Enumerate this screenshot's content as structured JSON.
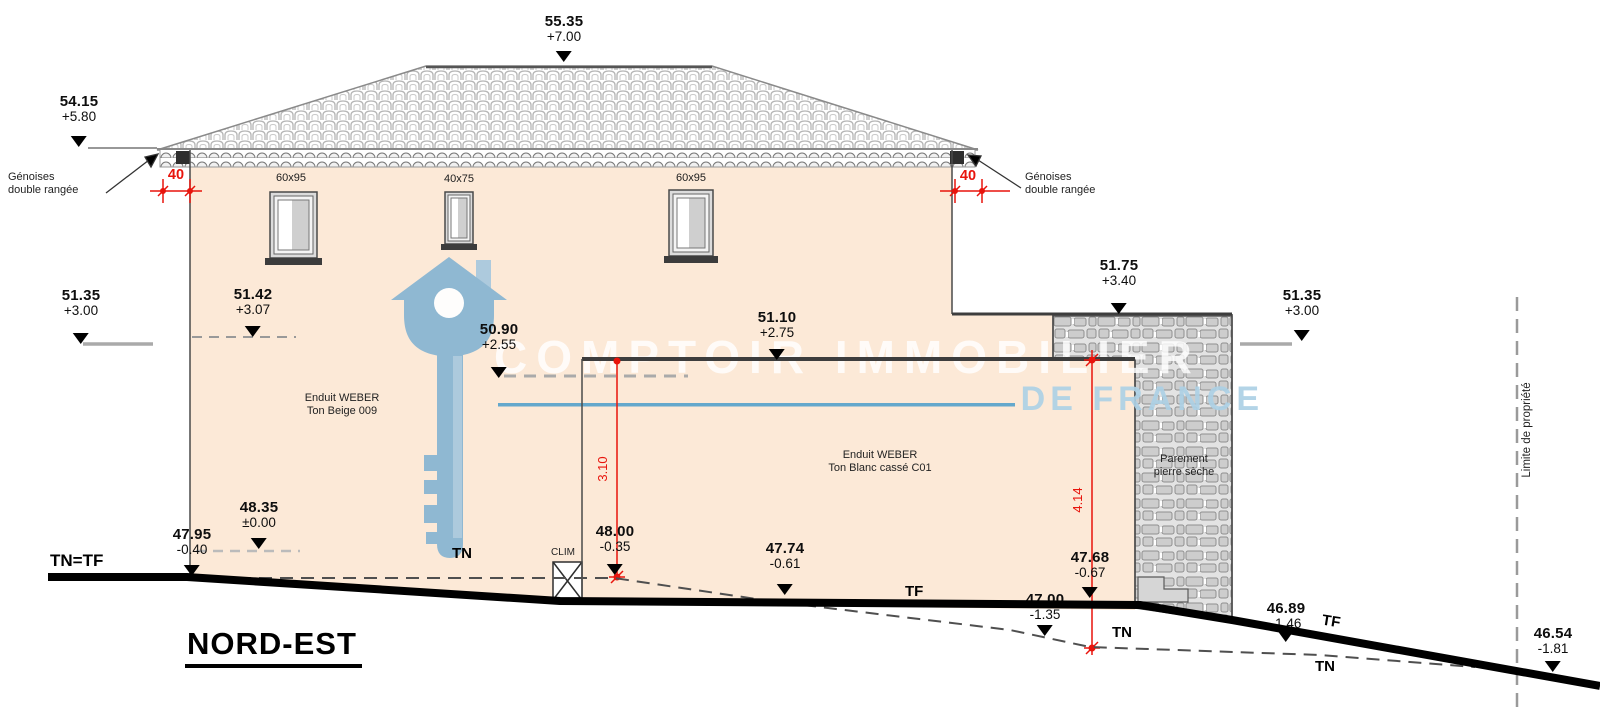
{
  "title": "NORD-EST",
  "watermark": {
    "brand_top": "COMPTOIR IMMOBILIER",
    "brand_bottom": "DE FRANCE"
  },
  "levels": [
    {
      "id": "ridge",
      "alt": "55.35",
      "rel": "+7.00"
    },
    {
      "id": "eaves-left",
      "alt": "54.15",
      "rel": "+5.80"
    },
    {
      "id": "left-upper",
      "alt": "51.35",
      "rel": "+3.00"
    },
    {
      "id": "wall-left",
      "alt": "51.42",
      "rel": "+3.07"
    },
    {
      "id": "ext-left-top",
      "alt": "50.90",
      "rel": "+2.55"
    },
    {
      "id": "ext-top",
      "alt": "51.10",
      "rel": "+2.75"
    },
    {
      "id": "stone-top",
      "alt": "51.75",
      "rel": "+3.40"
    },
    {
      "id": "right-upper",
      "alt": "51.35",
      "rel": "+3.00"
    },
    {
      "id": "floor-zero",
      "alt": "48.35",
      "rel": "±0.00"
    },
    {
      "id": "ground-left",
      "alt": "47.95",
      "rel": "-0.40"
    },
    {
      "id": "ground-clim",
      "alt": "48.00",
      "rel": "-0.35"
    },
    {
      "id": "ground-mid",
      "alt": "47.74",
      "rel": "-0.61"
    },
    {
      "id": "ground-right",
      "alt": "47.68",
      "rel": "-0.67"
    },
    {
      "id": "tn-low",
      "alt": "47.00",
      "rel": "-1.35"
    },
    {
      "id": "tf-right",
      "alt": "46.89",
      "rel": "-1.46"
    },
    {
      "id": "tn-far-right",
      "alt": "46.54",
      "rel": "-1.81"
    }
  ],
  "dimensions": {
    "overhang_left": "40",
    "overhang_right": "40",
    "ext_height": "3.10",
    "right_height": "4.14"
  },
  "windows": [
    {
      "label": "60x95"
    },
    {
      "label": "40x75"
    },
    {
      "label": "60x95"
    }
  ],
  "annotations": {
    "genoises_line1": "Génoises",
    "genoises_line2": "double rangée",
    "beige_line1": "Enduit WEBER",
    "beige_line2": "Ton Beige 009",
    "blanc_line1": "Enduit WEBER",
    "blanc_line2": "Ton Blanc cassé C01",
    "parement_line1": "Parement",
    "parement_line2": "pierre sèche",
    "limite": "Limite de propriété",
    "clim": "CLIM"
  },
  "ground_labels": {
    "tn_tf": "TN=TF",
    "tn": "TN",
    "tf": "TF"
  },
  "colors": {
    "wall_beige": "#fce9d7",
    "dim_red": "#e8140c",
    "watermark_blue": "#8ab6d2",
    "watermark_line_blue": "#64a8cc"
  }
}
